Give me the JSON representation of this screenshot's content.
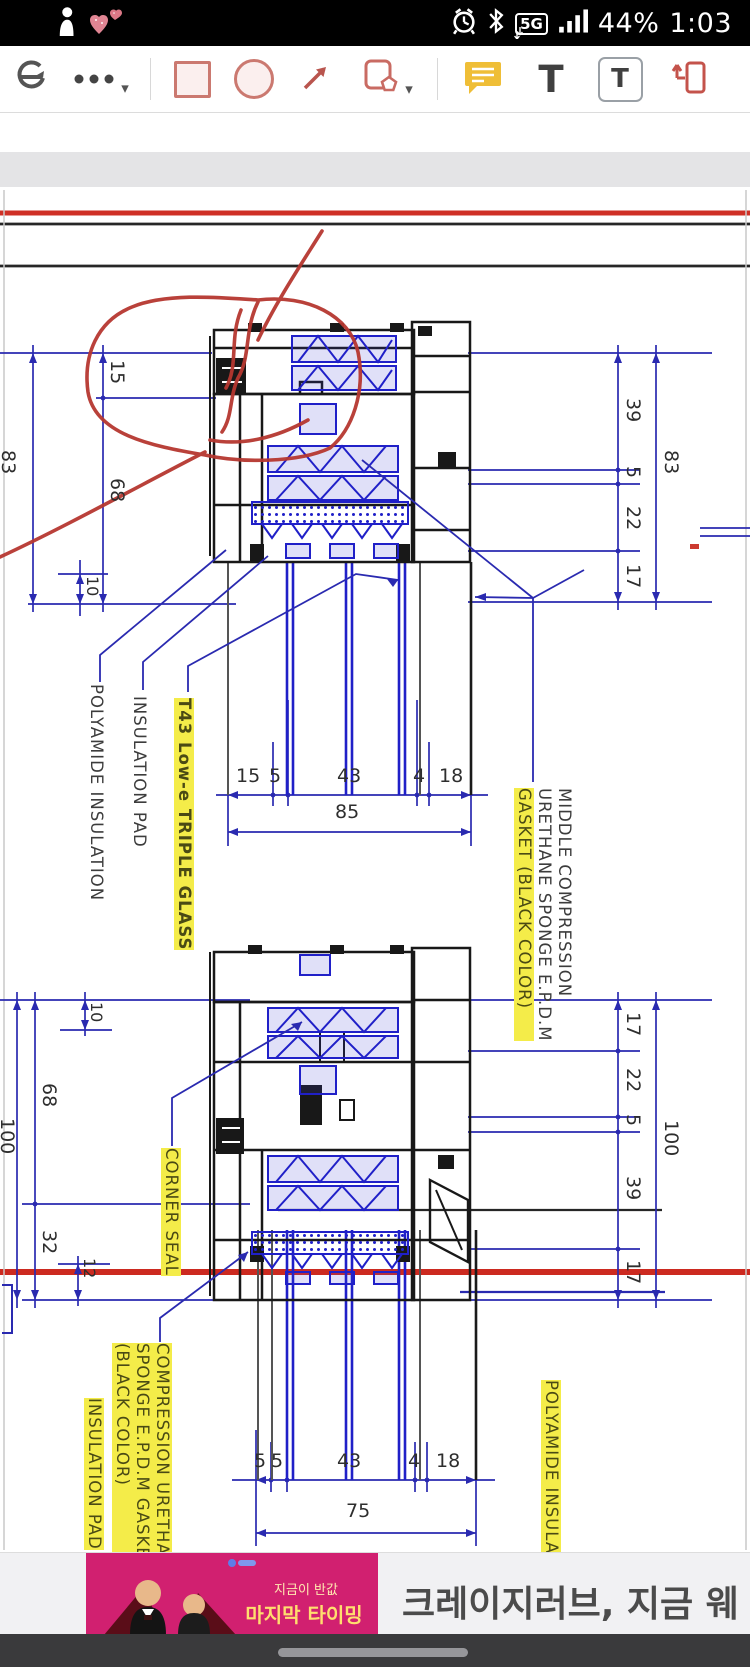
{
  "status_bar": {
    "time": "1:03",
    "battery": "44%",
    "network_badge": "5G",
    "icons": [
      "person-notification",
      "hearts-notification",
      "alarm",
      "bluetooth",
      "5g",
      "signal-strength"
    ]
  },
  "toolbar": {
    "scroll_toggle_icon": "continuous-scroll",
    "more_options": "more-tools",
    "shape_square": "rectangle-annotation",
    "shape_circle": "ellipse-annotation",
    "shape_arrow": "arrow-annotation",
    "shapes_menu": "shapes-menu",
    "comment_tool": "sticky-note",
    "text_tool_glyph": "T",
    "textbox_tool_glyph": "T",
    "callout_tool": "text-callout"
  },
  "drawing": {
    "labels": {
      "polyamide_top": "POLYAMIDE INSULATION",
      "insulation_pad_top": "INSULATION PAD",
      "t43_glass": "T43 Low-e TRIPLE GLASS",
      "middle_l1": "MIDDLE COMPRESSION",
      "middle_l2": "URETHANE SPONGE E.P.D.M",
      "middle_l3": "GASKET (BLACK COLOR)",
      "corner_seal": "CORNER SEAL",
      "comp_l1": "COMPRESSION URETHANE",
      "comp_l2": "SPONGE E.P.D.M GASKET",
      "comp_l3": "(BLACK COLOR)",
      "insulation_pad_bottom": "INSULATION PAD",
      "polyamide_bottom": "POLYAMIDE INSULATION"
    },
    "dims": {
      "tl_15": "15",
      "tl_68": "68",
      "tl_83": "83",
      "tl_10": "10",
      "tr_39": "39",
      "tr_5": "5",
      "tr_22": "22",
      "tr_17": "17",
      "tr_83": "83",
      "th_15": "15",
      "th_5": "5",
      "th_43": "43",
      "th_4": "4",
      "th_18": "18",
      "th_85": "85",
      "bl_10": "10",
      "bl_68": "68",
      "bl_32": "32",
      "bl_12": "12",
      "bl_100": "100",
      "br_17a": "17",
      "br_22": "22",
      "br_5": "5",
      "br_39": "39",
      "br_17b": "17",
      "br_100": "100",
      "bh_5a": "5",
      "bh_5b": "5",
      "bh_43": "43",
      "bh_4": "4",
      "bh_18": "18",
      "bh_75": "75"
    },
    "annotation_colors": {
      "freehand_red": "#b63730",
      "dimension_blue": "#2a2ab0",
      "highlight_yellow": "#f4ec49"
    }
  },
  "ad": {
    "promo_line1": "지금이 반값",
    "promo_line2": "마지막 타이밍",
    "headline": "크레이지러브, 지금 웨"
  }
}
